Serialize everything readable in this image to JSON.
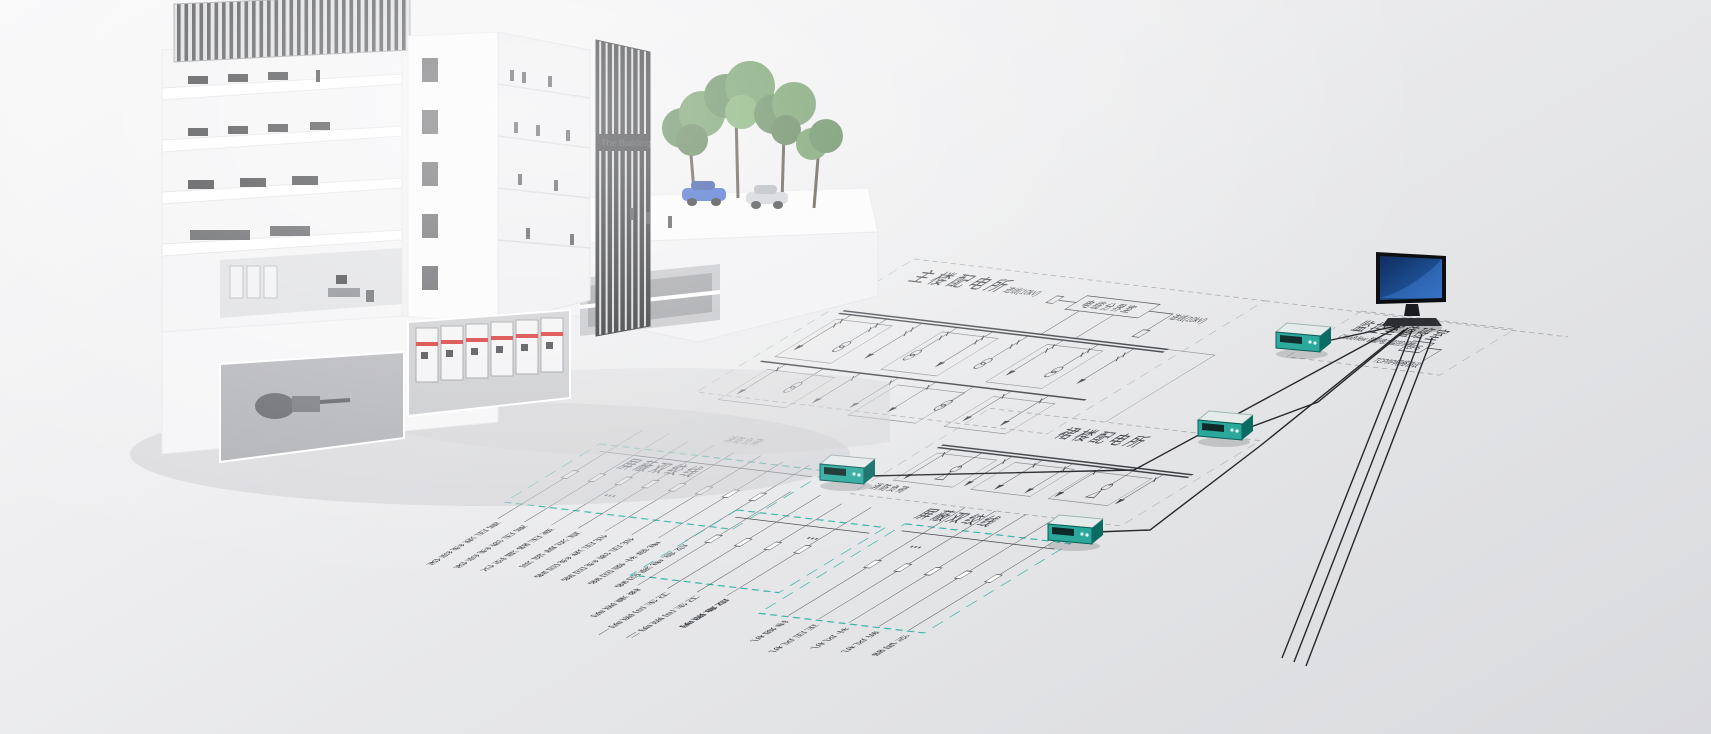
{
  "building": {
    "sign": "The Building"
  },
  "diagram": {
    "main_substation": {
      "title": "主楼配电所",
      "cable_room": "电缆分界室",
      "incoming_left": "进线(10kV)",
      "incoming_right": "进线(10kV)",
      "fire_load": "消防负荷"
    },
    "podium_substation": {
      "title": "裙楼配电所",
      "fire_load": "消防负荷"
    },
    "shielded_twisted_pair_left": "屏蔽双绞线",
    "shielded_twisted_pair_right": "屏蔽双绞线",
    "ellipsis": "···",
    "left_loads": [
      "高压进线综保",
      "高压馈线综保",
      "变压器温控仪",
      "直流屏监测",
      "低压进线回路",
      "低压馈线回路",
      "电容补偿回路",
      "应急电源回路"
    ],
    "middle_loads": [
      "楼道照明",
      "卫生间照明一",
      "卫生间照明二",
      "应急照明"
    ],
    "right_loads": [
      "排烟机",
      "正压风机",
      "补风机",
      "新风机",
      "空调器"
    ],
    "monitoring_room": {
      "title": "监控室值班室",
      "subtitle": "CloudView 智能电力监控系统",
      "ups": "UPS",
      "protocol": "TCP/IP网络协议"
    }
  },
  "colors": {
    "twisted_pair_teal": "#3ab5aa",
    "device_teal": "#2aa89c",
    "diagram_line": "#44474c",
    "screen_blue": "#1d4f93"
  }
}
